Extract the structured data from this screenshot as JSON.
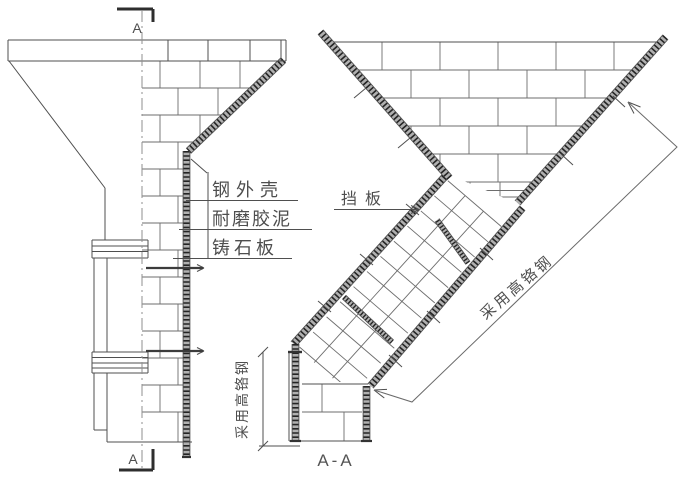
{
  "drawing": {
    "section_markers": {
      "top": "A",
      "bottom": "A"
    },
    "section_title": "A-A",
    "material_labels": {
      "layer1": "钢外壳",
      "layer2": "耐磨胶泥",
      "layer3": "铸石板"
    },
    "baffle_label": "挡板",
    "incline_note": "采用高铬钢",
    "vertical_note": "采用高铬钢",
    "colors": {
      "line": "#4f4f4f",
      "wall": "#242424",
      "text": "#555555",
      "background": "#ffffff"
    }
  }
}
